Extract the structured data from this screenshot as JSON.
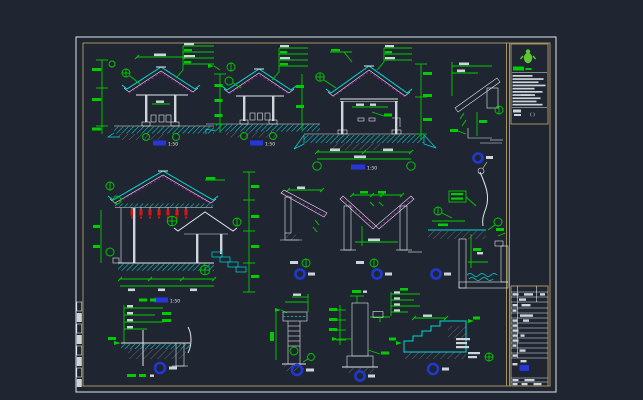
{
  "palette": {
    "background": "#202631",
    "frame_white": "#e2e6ea",
    "frame_tan": "#a3935f",
    "cad_green": "#00cc00",
    "cad_cyan": "#00d8d8",
    "cad_magenta": "#c000c0",
    "cad_red": "#e01212",
    "cad_white": "#e2e6ea",
    "label_blue": "#2636d8",
    "marker_blue": "#2038d0",
    "logo_green": "#5cc832"
  },
  "title_block": {
    "logo": "green-mascot-logo",
    "stamp_text": "( )"
  },
  "drawings": {
    "section_1": {
      "scale_label": "1:50"
    },
    "section_2": {
      "scale_label": "1:50"
    },
    "section_3": {
      "scale_label": "1:50"
    },
    "section_5": {
      "scale_label": "1:50"
    }
  }
}
